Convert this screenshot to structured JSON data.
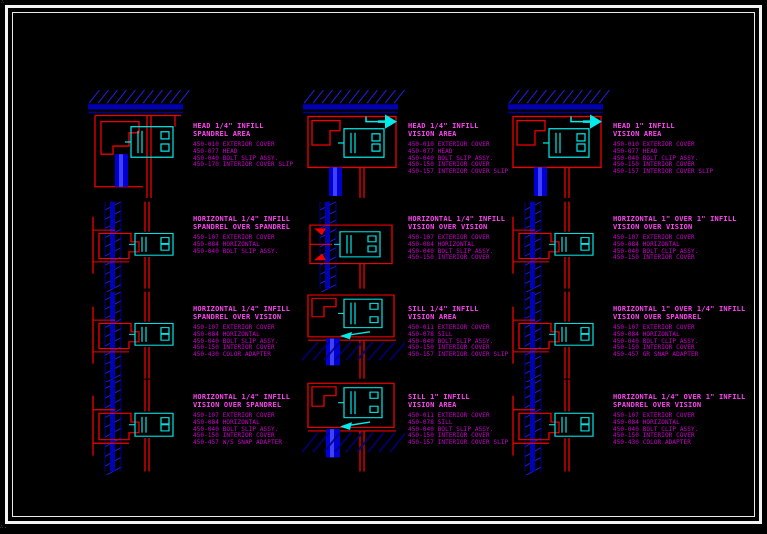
{
  "sheet": {
    "background": "#000000",
    "frame_color": "#f4f4f4",
    "linework_red": "#f20000",
    "linework_blue": "#2020e8",
    "mullion_fill_blue": "#0000cc",
    "glass_cyan": "#00eaea",
    "label_magenta": "#ff46f2",
    "parts_magenta": "#cf00cf"
  },
  "details": [
    {
      "title": [
        "HEAD 1/4\" INFILL",
        "SPANDREL AREA"
      ],
      "parts": [
        "450-010 EXTERIOR COVER",
        "450-077 HEAD",
        "450-040 BOLT SLIP ASSY.",
        "450-170 INTERIOR COVER SLIP"
      ]
    },
    {
      "title": [
        "HEAD 1/4\" INFILL",
        "VISION AREA"
      ],
      "parts": [
        "450-010 EXTERIOR COVER",
        "450-077 HEAD",
        "450-040 BOLT SLIP ASSY.",
        "450-150 INTERIOR COVER",
        "450-157 INTERIOR COVER SLIP"
      ]
    },
    {
      "title": [
        "HEAD 1\" INFILL",
        "VISION AREA"
      ],
      "parts": [
        "450-010 EXTERIOR COVER",
        "450-077 HEAD",
        "450-040 BOLT CLIP ASSY.",
        "450-150 INTERIOR COVER",
        "450-157 INTERIOR COVER SLIP"
      ]
    },
    {
      "title": [
        "HORIZONTAL 1/4\" INFILL",
        "SPANDREL OVER SPANDREL"
      ],
      "parts": [
        "450-107 EXTERIOR COVER",
        "450-084 HORIZONTAL",
        "450-040 BOLT SLIP ASSY."
      ]
    },
    {
      "title": [
        "HORIZONTAL 1/4\" INFILL",
        "VISION OVER VISION"
      ],
      "parts": [
        "450-107 EXTERIOR COVER",
        "450-084 HORIZONTAL",
        "450-040 BOLT SLIP ASSY.",
        "450-150 INTERIOR COVER"
      ]
    },
    {
      "title": [
        "HORIZONTAL 1\" OVER 1\" INFILL",
        "VISION OVER VISION"
      ],
      "parts": [
        "450-107 EXTERIOR COVER",
        "450-084 HORIZONTAL",
        "450-040 BOLT CLIP ASSY.",
        "450-150 INTERIOR COVER"
      ]
    },
    {
      "title": [
        "HORIZONTAL 1/4\" INFILL",
        "SPANDREL OVER VISION"
      ],
      "parts": [
        "450-107 EXTERIOR COVER",
        "450-084 HORIZONTAL",
        "450-040 BOLT SLIP ASSY.",
        "450-150 INTERIOR COVER",
        "450-430 COLOR ADAPTER"
      ]
    },
    {
      "title": [
        "SILL 1/4\" INFILL",
        "VISION AREA"
      ],
      "parts": [
        "450-011 EXTERIOR COVER",
        "450-078 SILL",
        "450-040 BOLT SLIP ASSY.",
        "450-150 INTERIOR COVER",
        "450-157 INTERIOR COVER SLIP"
      ]
    },
    {
      "title": [
        "HORIZONTAL 1\" OVER 1/4\" INFILL",
        "VISION OVER SPANDREL"
      ],
      "parts": [
        "450-107 EXTERIOR COVER",
        "450-084 HORIZONTAL",
        "450-040 BOLT CLIP ASSY.",
        "450-150 INTERIOR COVER",
        "450-457 GR SNAP ADAPTER"
      ]
    },
    {
      "title": [
        "HORIZONTAL 1/4\" INFILL",
        "VISION OVER SPANDREL"
      ],
      "parts": [
        "450-107 EXTERIOR COVER",
        "450-084 HORIZONTAL",
        "450-040 BOLT SLIP ASSY.",
        "450-150 INTERIOR COVER",
        "450-457 W/S SNAP ADAPTER"
      ]
    },
    {
      "title": [
        "SILL 1\" INFILL",
        "VISION AREA"
      ],
      "parts": [
        "450-011 EXTERIOR COVER",
        "450-078 SILL",
        "450-040 BOLT SLIP ASSY.",
        "450-150 INTERIOR COVER",
        "450-157 INTERIOR COVER SLIP"
      ]
    },
    {
      "title": [
        "HORIZONTAL 1/4\" OVER 1\" INFILL",
        "SPANDREL OVER VISION"
      ],
      "parts": [
        "450-107 EXTERIOR COVER",
        "450-084 HORIZONTAL",
        "450-040 BOLT CLIP ASSY.",
        "450-150 INTERIOR COVER",
        "450-430 COLOR ADAPTER"
      ]
    }
  ]
}
